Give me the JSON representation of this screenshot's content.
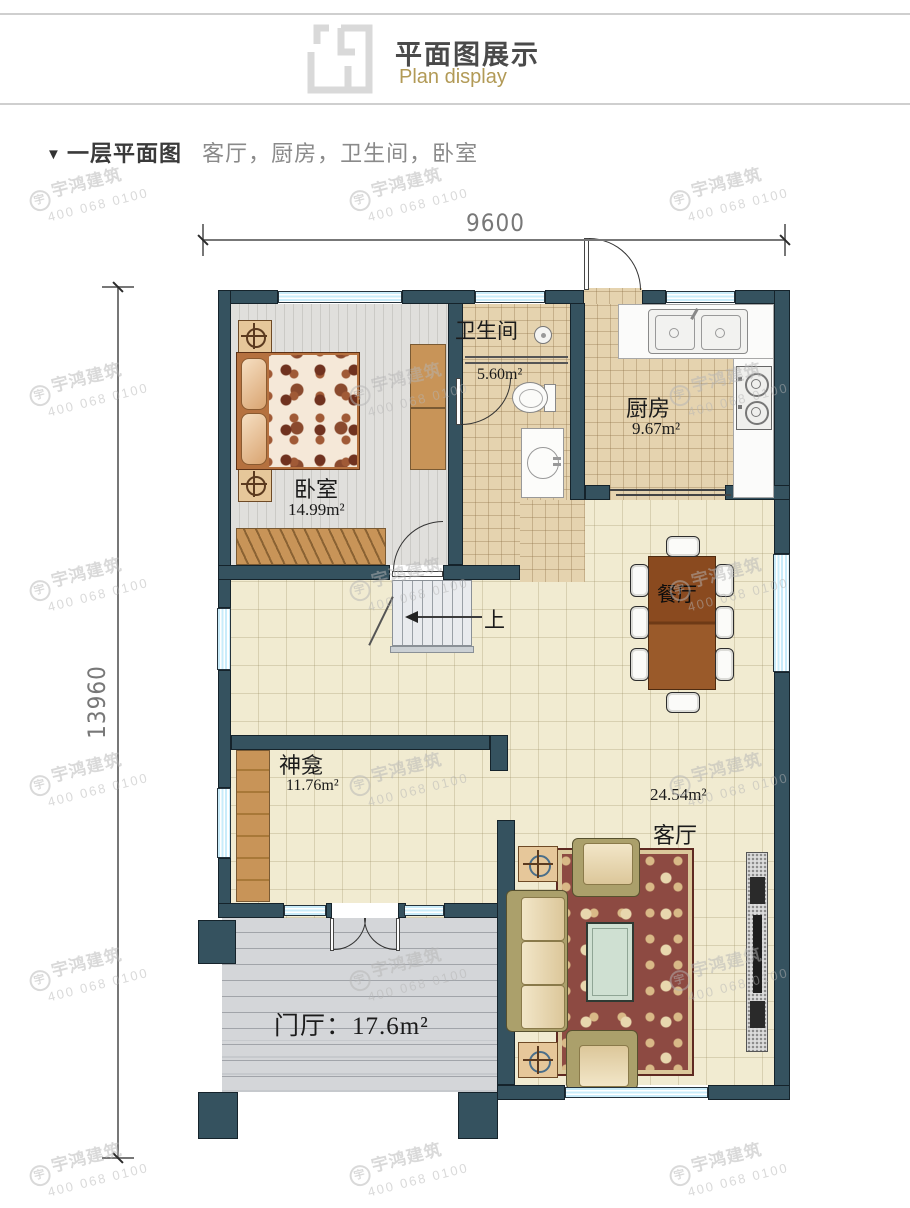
{
  "header": {
    "title": "平面图展示",
    "subtitle": "Plan display"
  },
  "section": {
    "marker": "▼",
    "title": "一层平面图",
    "subtitle": "客厅，厨房，卫生间，卧室"
  },
  "dimensions": {
    "width": "9600",
    "height": "13960"
  },
  "rooms": {
    "bedroom": {
      "name": "卧室",
      "area": "14.99m²"
    },
    "bathroom": {
      "name": "卫生间",
      "area": "5.60m²"
    },
    "kitchen": {
      "name": "厨房",
      "area": "9.67m²"
    },
    "dining": {
      "name": "餐厅"
    },
    "shrine": {
      "name": "神龛",
      "area": "11.76m²"
    },
    "living": {
      "name": "客厅",
      "area": "24.54m²"
    },
    "foyer": {
      "label": "门厅：17.6m²"
    }
  },
  "stairs": {
    "up_label": "上"
  },
  "watermark": {
    "logo": "宇",
    "brand": "宇鸿建筑",
    "phone": "400 068 0100"
  },
  "colors": {
    "wall": "#35525f",
    "window": "#c9ecfa",
    "floor_cream": "#f1ebd1",
    "floor_tan": "#e5d3af",
    "floor_wood_gray": "#dedddb",
    "porch": "#d4d6d9",
    "carpet": "#8d4a42",
    "wood_furniture": "#c89458",
    "dining_table": "#8a4a1f",
    "accent_gold": "#b29a56"
  }
}
